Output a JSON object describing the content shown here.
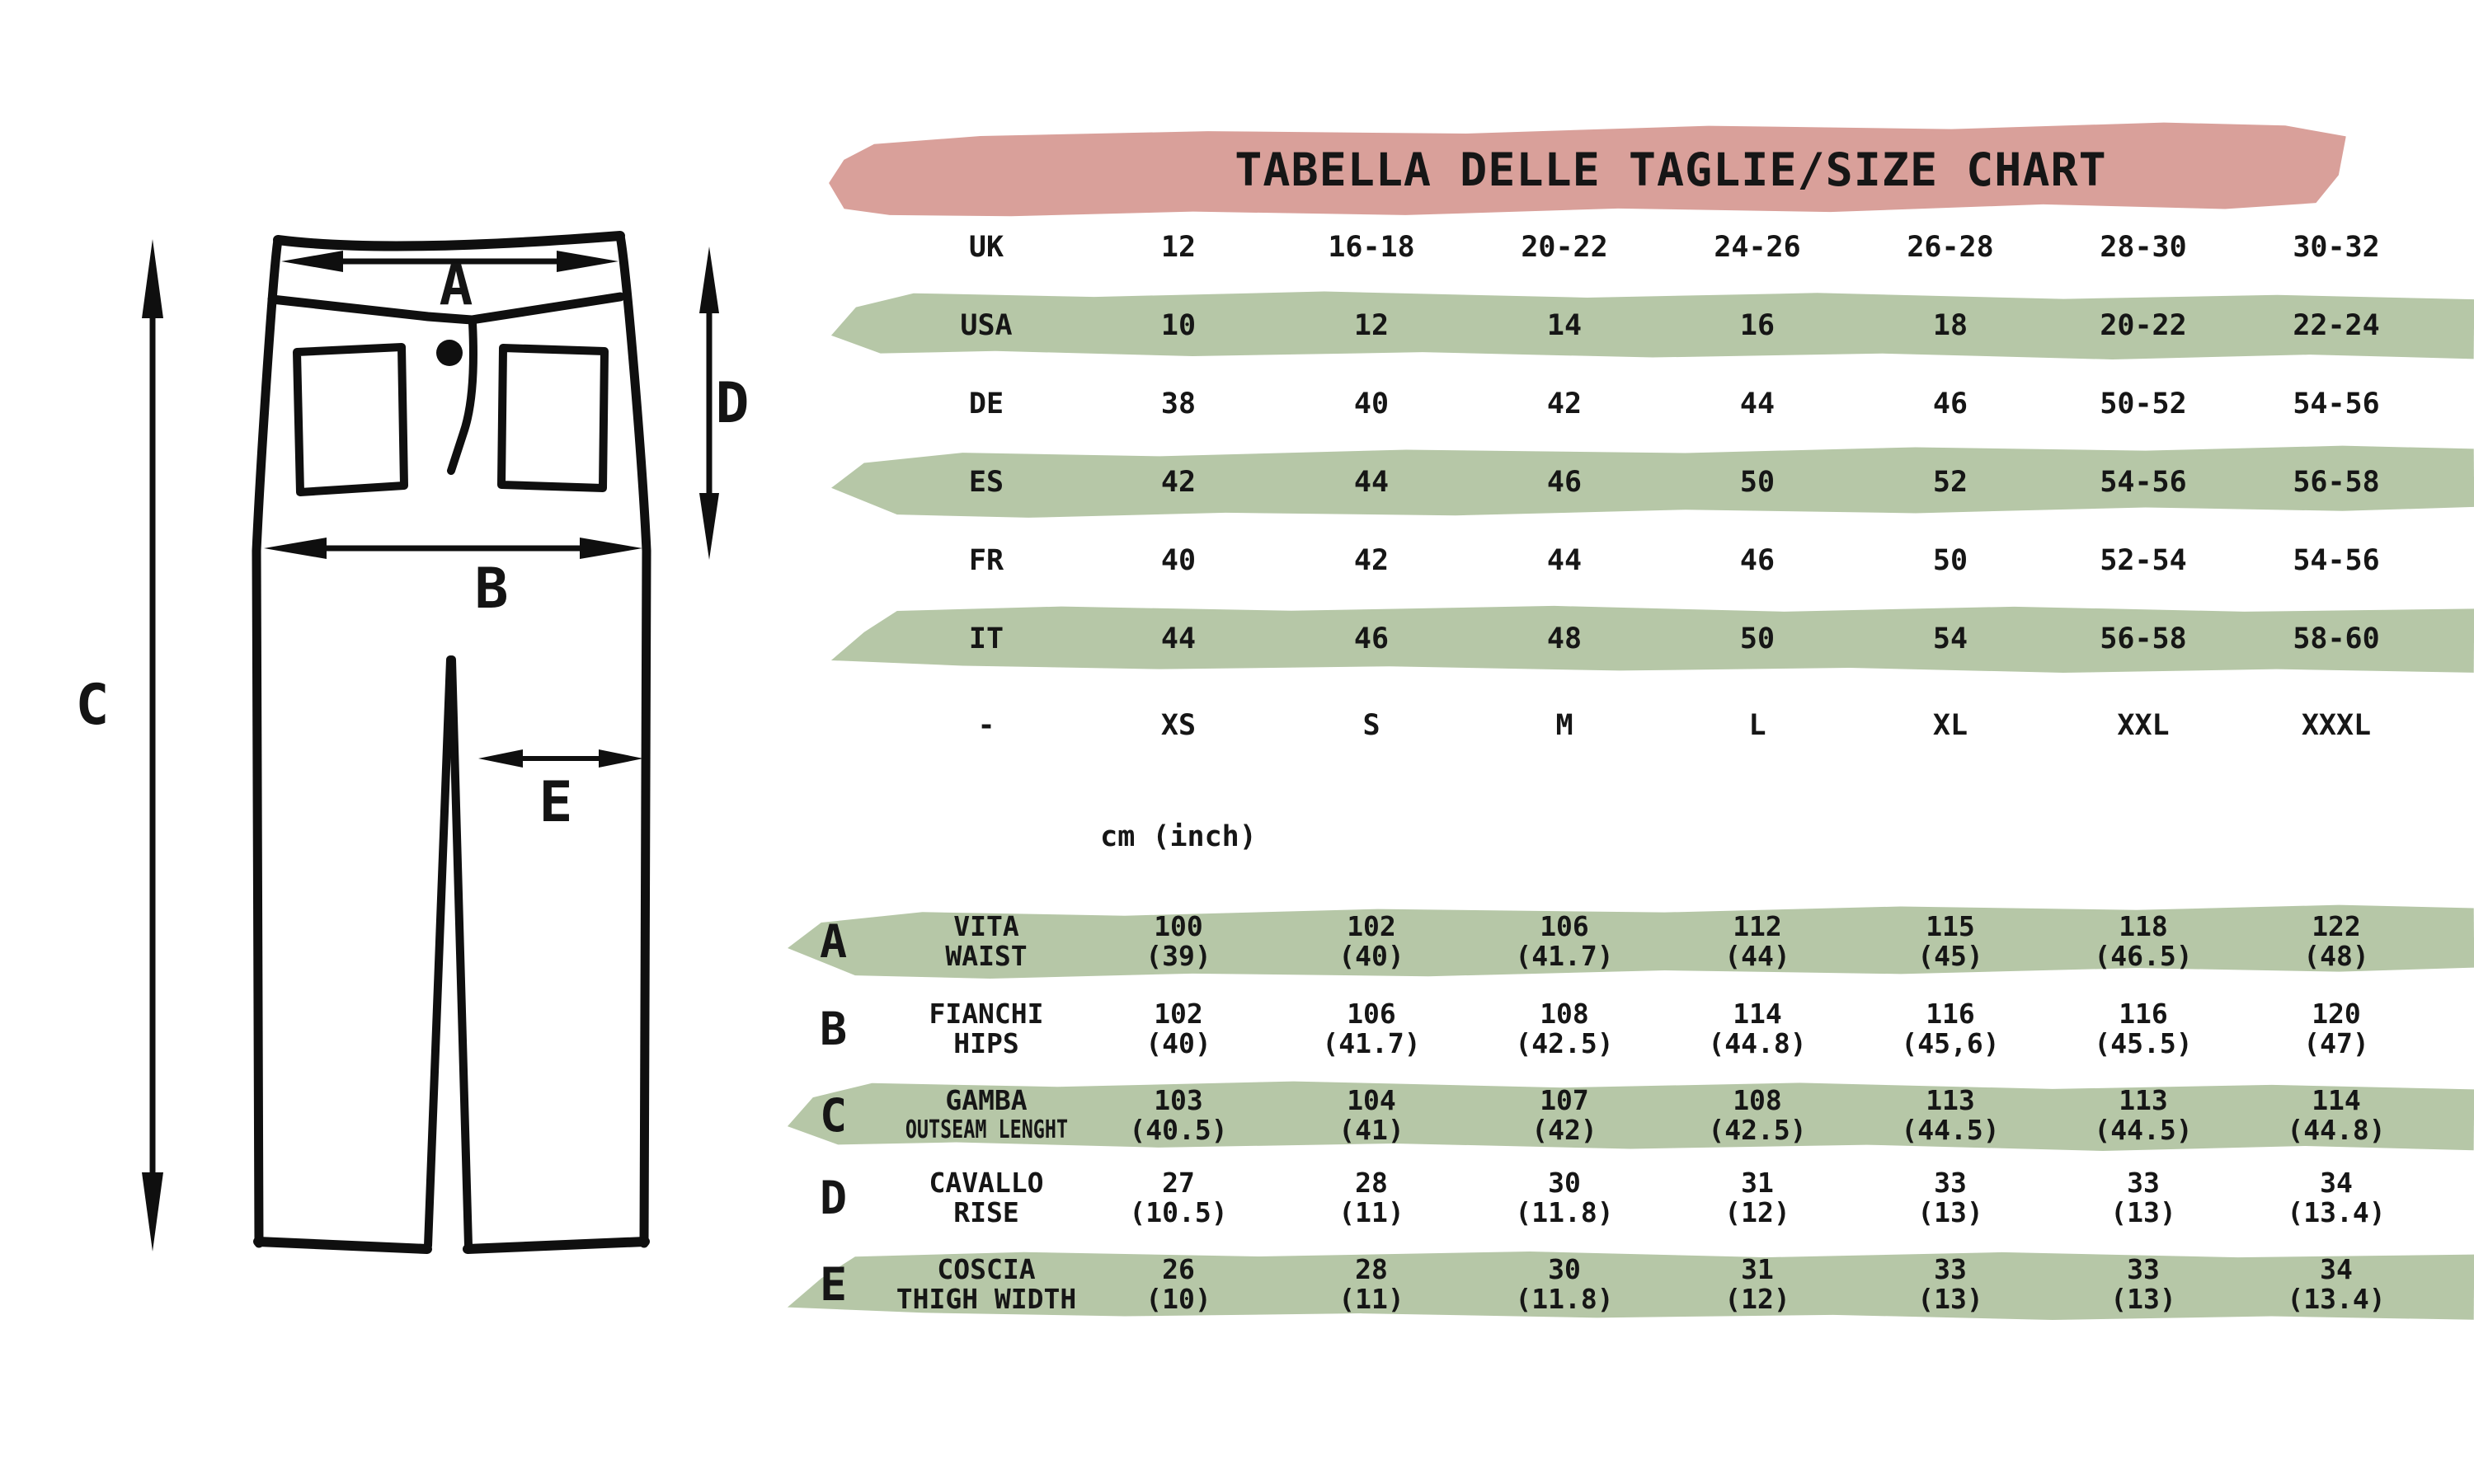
{
  "title": "TABELLA DELLE TAGLIE/SIZE CHART",
  "unit_label": "cm (inch)",
  "colors": {
    "pink": "#d9a09a",
    "green": "#b6c7a7",
    "ink": "#161616"
  },
  "size_rows": [
    {
      "region": "UK",
      "highlight": false,
      "values": [
        "12",
        "16-18",
        "20-22",
        "24-26",
        "26-28",
        "28-30",
        "30-32"
      ]
    },
    {
      "region": "USA",
      "highlight": true,
      "values": [
        "10",
        "12",
        "14",
        "16",
        "18",
        "20-22",
        "22-24"
      ]
    },
    {
      "region": "DE",
      "highlight": false,
      "values": [
        "38",
        "40",
        "42",
        "44",
        "46",
        "50-52",
        "54-56"
      ]
    },
    {
      "region": "ES",
      "highlight": true,
      "values": [
        "42",
        "44",
        "46",
        "50",
        "52",
        "54-56",
        "56-58"
      ]
    },
    {
      "region": "FR",
      "highlight": false,
      "values": [
        "40",
        "42",
        "44",
        "46",
        "50",
        "52-54",
        "54-56"
      ]
    },
    {
      "region": "IT",
      "highlight": true,
      "values": [
        "44",
        "46",
        "48",
        "50",
        "54",
        "56-58",
        "58-60"
      ]
    },
    {
      "region": "-",
      "highlight": false,
      "values": [
        "XS",
        "S",
        "M",
        "L",
        "XL",
        "XXL",
        "XXXL"
      ]
    }
  ],
  "measurement_rows": [
    {
      "letter": "A",
      "label_it": "VITA",
      "label_en": "WAIST",
      "cm": [
        "100",
        "102",
        "106",
        "112",
        "115",
        "118",
        "122"
      ],
      "inch": [
        "(39)",
        "(40)",
        "(41.7)",
        "(44)",
        "(45)",
        "(46.5)",
        "(48)"
      ],
      "highlight": true
    },
    {
      "letter": "B",
      "label_it": "FIANCHI",
      "label_en": "HIPS",
      "cm": [
        "102",
        "106",
        "108",
        "114",
        "116",
        "116",
        "120"
      ],
      "inch": [
        "(40)",
        "(41.7)",
        "(42.5)",
        "(44.8)",
        "(45,6)",
        "(45.5)",
        "(47)"
      ],
      "highlight": false
    },
    {
      "letter": "C",
      "label_it": "GAMBA",
      "label_en": "OUTSEAM LENGHT",
      "cm": [
        "103",
        "104",
        "107",
        "108",
        "113",
        "113",
        "114"
      ],
      "inch": [
        "(40.5)",
        "(41)",
        "(42)",
        "(42.5)",
        "(44.5)",
        "(44.5)",
        "(44.8)"
      ],
      "highlight": true
    },
    {
      "letter": "D",
      "label_it": "CAVALLO",
      "label_en": "RISE",
      "cm": [
        "27",
        "28",
        "30",
        "31",
        "33",
        "33",
        "34"
      ],
      "inch": [
        "(10.5)",
        "(11)",
        "(11.8)",
        "(12)",
        "(13)",
        "(13)",
        "(13.4)"
      ],
      "highlight": false
    },
    {
      "letter": "E",
      "label_it": "COSCIA",
      "label_en": "THIGH WIDTH",
      "cm": [
        "26",
        "28",
        "30",
        "31",
        "33",
        "33",
        "34"
      ],
      "inch": [
        "(10)",
        "(11)",
        "(11.8)",
        "(12)",
        "(13)",
        "(13)",
        "(13.4)"
      ],
      "highlight": true
    }
  ],
  "diagram": {
    "labels": [
      "A",
      "B",
      "C",
      "D",
      "E"
    ]
  }
}
